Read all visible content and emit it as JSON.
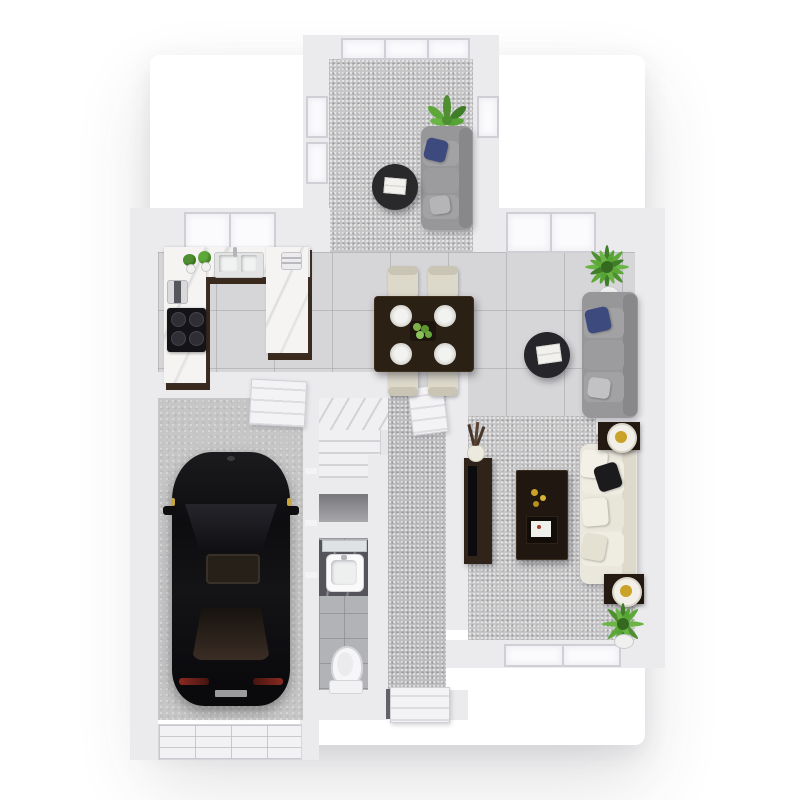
{
  "meta": {
    "title": "3D rendered floor plan — ground floor, top-down view",
    "type": "architectural 3D floor plan render",
    "canvas": {
      "width": 800,
      "height": 800
    },
    "background": "#ffffff",
    "visible_text": "none"
  },
  "palette": {
    "wall": "#ebebee",
    "wall_edge": "#d6d6db",
    "carpet_grey": "#c6c6c7",
    "hall_carpet": "#bcbcbe",
    "tile_large": "#d6d6d8",
    "tile_bath": "#b2b3b6",
    "concrete": "#c6c6c7",
    "counter_marble": "#f5f4f2",
    "cabinet_wood": "#3a2a1d",
    "dining_table_wood": "#2b2014",
    "sofa_grey": "#97979a",
    "sofa_cream": "#eae7dd",
    "pillow_navy": "#3d4a7d",
    "pillow_black": "#1b1b1d",
    "coffee_table_black": "#29292c",
    "plant_green": "#4e8f2f",
    "car_black": "#141416",
    "car_glass_tint": "#3a2d24",
    "lamp_gold": "#c9a227",
    "taillight_red": "#8a2a22",
    "window_glass": "#fbfbfd"
  },
  "rooms": [
    {
      "id": "sunroom",
      "name": "Sunroom lounge",
      "floor": "grey carpet",
      "items": [
        "grey three-seat sofa with navy cushion",
        "round black coffee table with white books",
        "potted plant",
        "wall of picture windows"
      ]
    },
    {
      "id": "kitchen",
      "name": "Kitchen",
      "floor": "large grey tile",
      "items": [
        "U-shaped counter with marble top and dark wood base",
        "double sink with faucet",
        "black cooktop",
        "toaster",
        "coffee machine",
        "two potted herbs",
        "two windows"
      ]
    },
    {
      "id": "dining",
      "name": "Dining area",
      "floor": "large grey tile",
      "items": [
        "dark wood dining table",
        "four cream chairs",
        "four white place settings",
        "green fruit centerpiece"
      ]
    },
    {
      "id": "living",
      "name": "Living area",
      "floor": "large grey tile",
      "items": [
        "grey sofa with navy cushion",
        "round black side table with white books",
        "potted palm",
        "windows on top wall"
      ]
    },
    {
      "id": "family",
      "name": "Family room",
      "floor": "grey carpet",
      "items": [
        "cream sofa with white and black pillows",
        "dark wood coffee table with gold decor",
        "media console with flat TV and vase of dried stems",
        "two dark end tables with gold-and-white lamps",
        "potted palm",
        "two low windows on bottom wall"
      ]
    },
    {
      "id": "hallway",
      "name": "Hallway",
      "floor": "grey carpet",
      "items": [
        "open panelled interior door",
        "panelled front door, slightly ajar"
      ]
    },
    {
      "id": "stairs",
      "name": "Winder staircase",
      "floor": "white painted treads",
      "items": []
    },
    {
      "id": "closet",
      "name": "Under-stair closet",
      "floor": "shadowed",
      "items": []
    },
    {
      "id": "bathroom",
      "name": "Bathroom",
      "floor": "small grey tile",
      "items": [
        "vanity with dark stone top and white basin",
        "mirror",
        "toilet"
      ]
    },
    {
      "id": "garage",
      "name": "Garage",
      "floor": "concrete",
      "items": [
        "black car parked nose-up",
        "white sectional garage door",
        "open service door to house"
      ]
    }
  ],
  "vehicle": {
    "type": "car",
    "color": "black",
    "details": [
      "windshield",
      "tinted sunroof",
      "tinted rear window",
      "two side mirrors",
      "red tail lights",
      "license plate",
      "amber side markers"
    ]
  }
}
